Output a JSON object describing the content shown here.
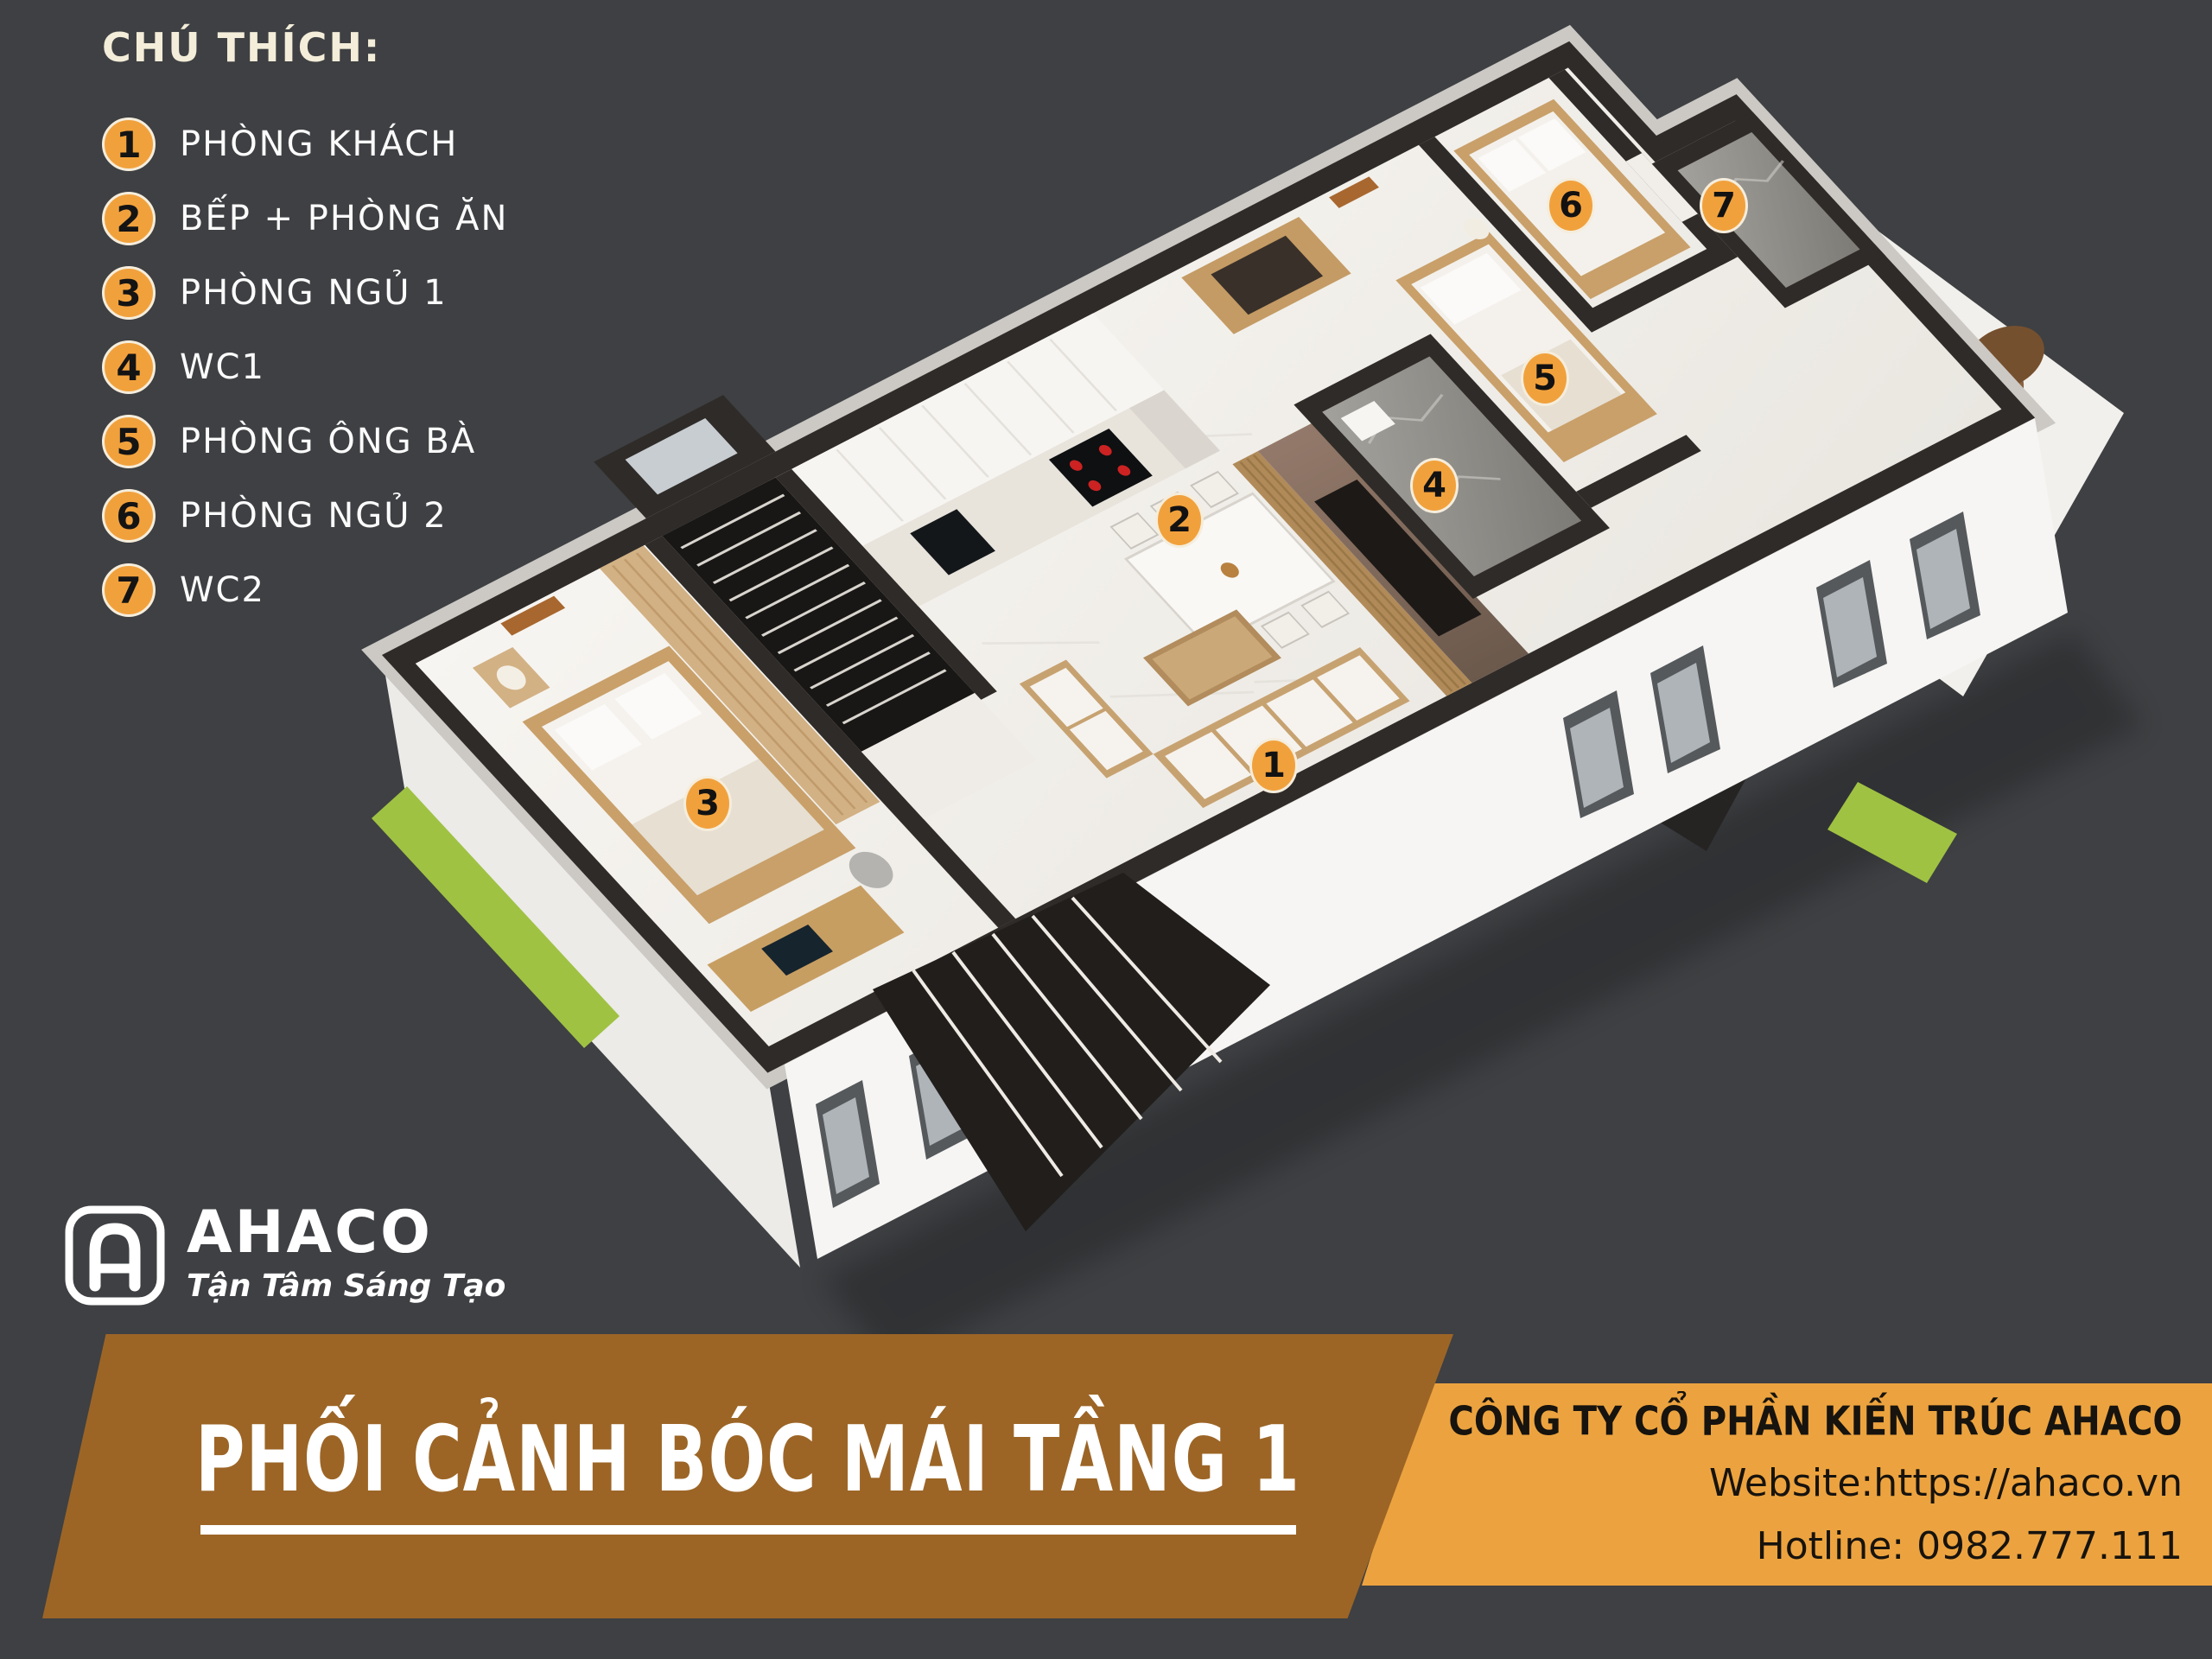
{
  "legend": {
    "title": "CHÚ THÍCH:",
    "items": [
      {
        "number": "1",
        "label": "PHÒNG KHÁCH"
      },
      {
        "number": "2",
        "label": "BẾP + PHÒNG ĂN"
      },
      {
        "number": "3",
        "label": "PHÒNG NGỦ 1"
      },
      {
        "number": "4",
        "label": "WC1"
      },
      {
        "number": "5",
        "label": "PHÒNG ÔNG BÀ"
      },
      {
        "number": "6",
        "label": "PHÒNG NGỦ 2"
      },
      {
        "number": "7",
        "label": "WC2"
      }
    ]
  },
  "markers": [
    {
      "number": "1",
      "room": "PHÒNG KHÁCH"
    },
    {
      "number": "2",
      "room": "BẾP + PHÒNG ĂN"
    },
    {
      "number": "3",
      "room": "PHÒNG NGỦ 1"
    },
    {
      "number": "4",
      "room": "WC1"
    },
    {
      "number": "5",
      "room": "PHÒNG ÔNG BÀ"
    },
    {
      "number": "6",
      "room": "PHÒNG NGỦ 2"
    },
    {
      "number": "7",
      "room": "WC2"
    }
  ],
  "logo": {
    "brand": "AHACO",
    "tagline": "Tận Tâm Sáng Tạo"
  },
  "banner": {
    "title": "PHỐI CẢNH BÓC MÁI TẦNG 1"
  },
  "company": {
    "name": "CÔNG TY CỔ PHẦN KIẾN TRÚC AHACO",
    "website": "Website:https://ahaco.vn",
    "hotline": "Hotline: 0982.777.111"
  },
  "colors": {
    "background": "#3E4043",
    "accent_orange": "#F1A13C",
    "panel_brown": "#9C6526",
    "panel_orange": "#ECA33F",
    "wall_dark": "#2F2B28"
  }
}
